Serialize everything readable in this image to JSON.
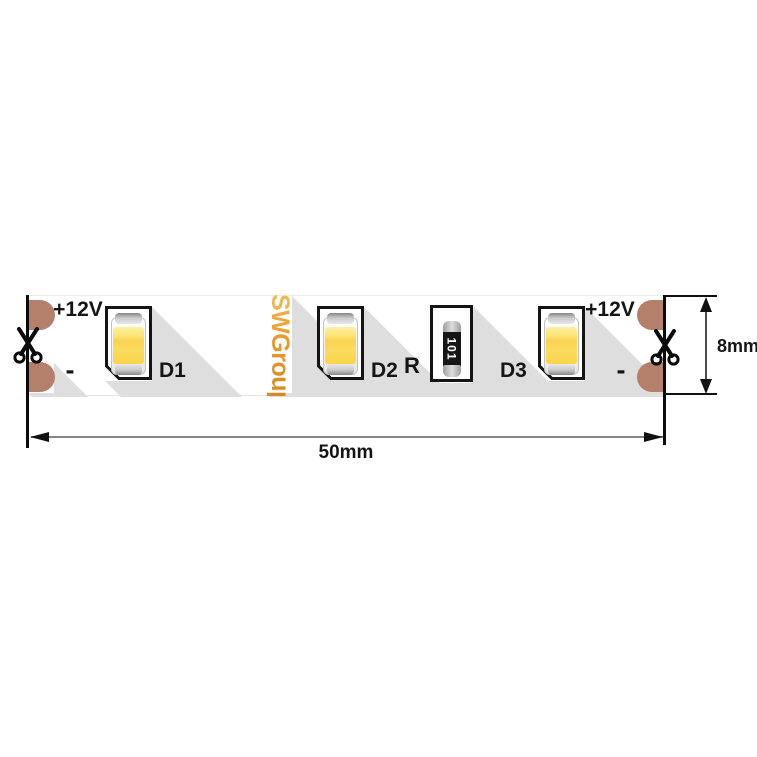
{
  "diagram": {
    "brand": "SWGroup",
    "strip": {
      "left_terminal": {
        "positive": "+12V",
        "negative": "-"
      },
      "right_terminal": {
        "positive": "+12V",
        "negative": "-"
      },
      "leds": [
        {
          "label": "D1"
        },
        {
          "label": "D2"
        },
        {
          "label": "D3"
        }
      ],
      "resistor": {
        "label": "R",
        "code": "101"
      }
    },
    "dimensions": {
      "length": "50mm",
      "width": "8mm"
    },
    "colors": {
      "pad_copper": "#B5806B",
      "brand_orange": "#E89A2C",
      "led_yellow": "#FAD54B",
      "shadow_gray": "#DEDEDE",
      "line_black": "#111111"
    },
    "icons": {
      "cut_left": "scissors-icon",
      "cut_right": "scissors-icon"
    }
  }
}
